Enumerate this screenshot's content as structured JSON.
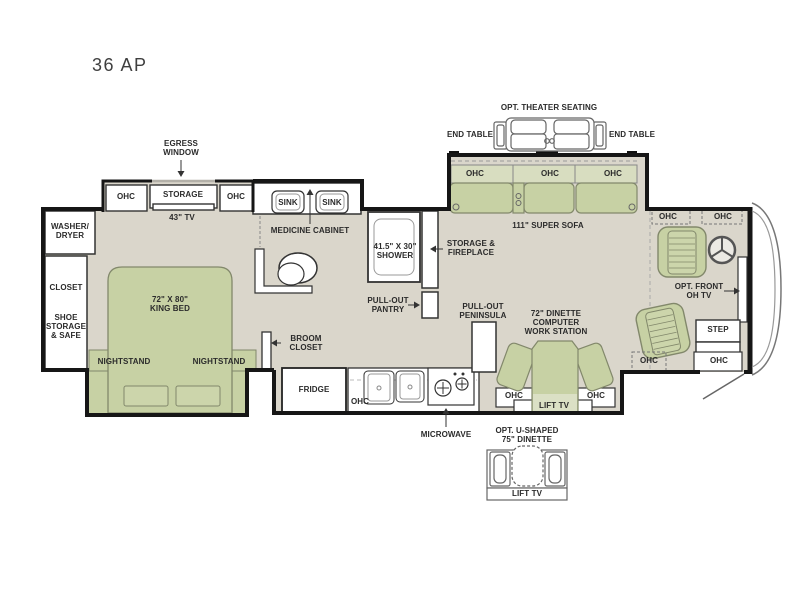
{
  "title": "36 AP",
  "colors": {
    "floor": "#dad6cb",
    "furniture_green": "#c7d1a4",
    "furniture_light_green": "#d8ddc0",
    "cushion_green": "#ccd5ab",
    "wall": "#161616",
    "furniture_outline": "#82886b"
  },
  "labels": {
    "egress_window": "EGRESS\nWINDOW",
    "bedroom_ohc_left": "OHC",
    "bedroom_storage": "STORAGE",
    "bedroom_ohc_right": "OHC",
    "bedroom_tv": "43\" TV",
    "washer_dryer": "WASHER/\nDRYER",
    "closet": "CLOSET",
    "shoe_storage": "SHOE\nSTORAGE\n& SAFE",
    "king_bed": "72\" X 80\"\nKING BED",
    "nightstand_left": "NIGHTSTAND",
    "nightstand_right": "NIGHTSTAND",
    "sink_left": "SINK",
    "sink_right": "SINK",
    "medicine_cabinet": "MEDICINE CABINET",
    "shower": "41.5\" X 30\"\nSHOWER",
    "storage_fireplace": "STORAGE &\nFIREPLACE",
    "pullout_pantry": "PULL-OUT\nPANTRY",
    "broom_closet": "BROOM\nCLOSET",
    "fridge": "FRIDGE",
    "kitchen_ohc": "OHC",
    "microwave": "MICROWAVE",
    "pullout_peninsula": "PULL-OUT\nPENINSULA",
    "theater_seating": "OPT. THEATER SEATING",
    "end_table_left": "END TABLE",
    "end_table_right": "END TABLE",
    "sofa_ohc_1": "OHC",
    "sofa_ohc_2": "OHC",
    "sofa_ohc_3": "OHC",
    "super_sofa": "111\" SUPER SOFA",
    "front_ohc_left": "OHC",
    "front_ohc_right": "OHC",
    "front_tv": "OPT. FRONT\nOH TV",
    "step": "STEP",
    "front_lower_ohc_left": "OHC",
    "front_lower_ohc_right": "OHC",
    "dinette": "72\" DINETTE\nCOMPUTER\nWORK STATION",
    "dinette_ohc_left": "OHC",
    "dinette_ohc_right": "OHC",
    "dinette_lift_tv": "LIFT TV",
    "u_dinette": "OPT. U-SHAPED\n75\" DINETTE",
    "u_dinette_lift_tv": "LIFT TV"
  }
}
